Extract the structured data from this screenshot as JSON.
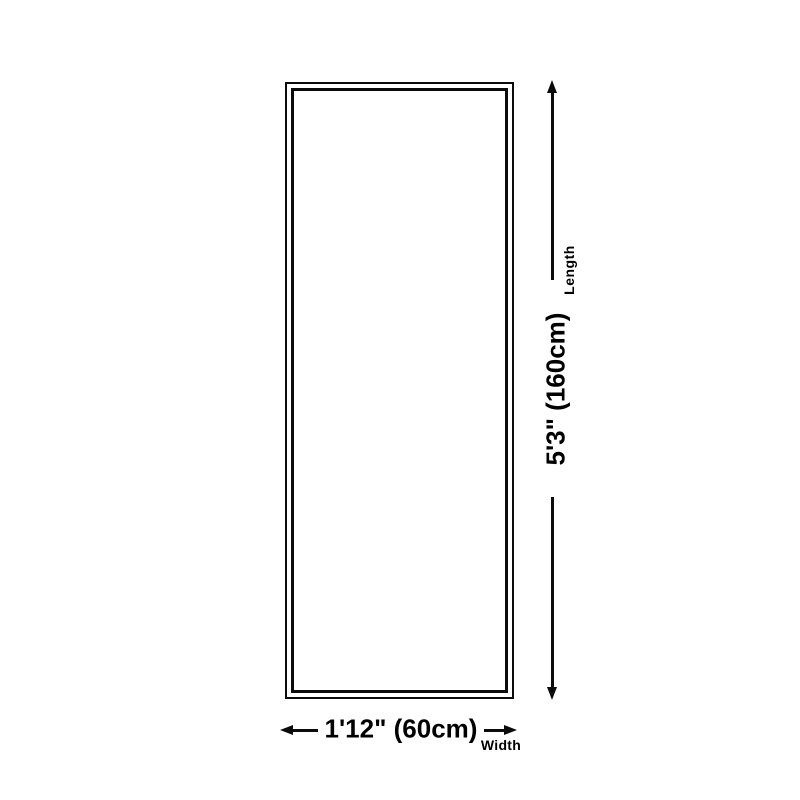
{
  "diagram": {
    "length": {
      "label": "Length",
      "value": "5'3\" (160cm)"
    },
    "width": {
      "label": "Width",
      "value": "1'12\" (60cm)"
    },
    "colors": {
      "line": "#0b0b0b",
      "background": "#ffffff"
    },
    "icons": {
      "arrow_up": "css-triangle-up",
      "arrow_down": "css-triangle-down",
      "arrow_left": "css-triangle-left",
      "arrow_right": "css-triangle-right"
    }
  }
}
